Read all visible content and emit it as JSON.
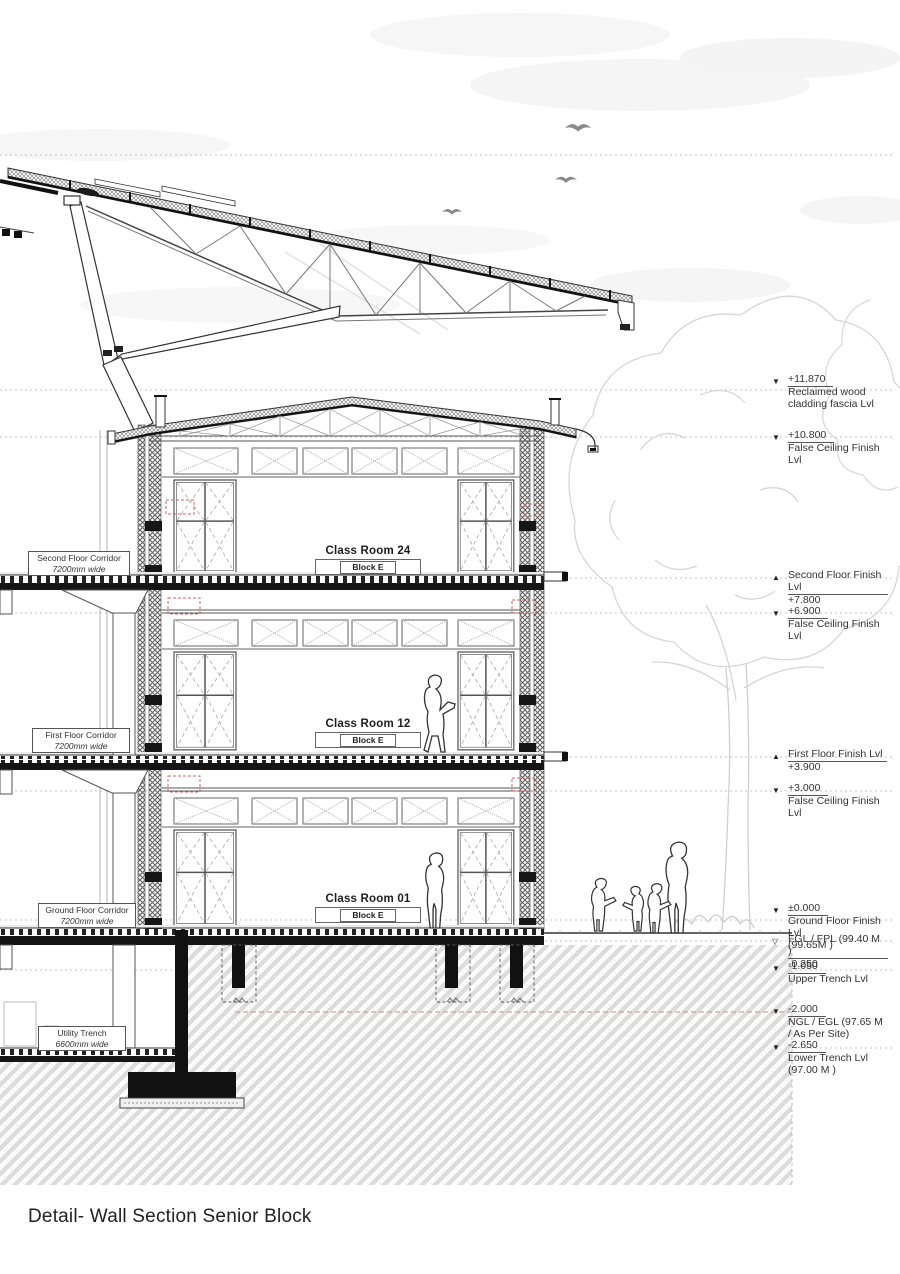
{
  "page": {
    "title": "Detail- Wall Section Senior Block"
  },
  "rooms": [
    {
      "name": "Class Room 24",
      "block": "Block E"
    },
    {
      "name": "Class Room 12",
      "block": "Block E"
    },
    {
      "name": "Class Room 01",
      "block": "Block E"
    }
  ],
  "corridors": [
    {
      "name": "Second Floor Corridor",
      "width": "7200mm wide"
    },
    {
      "name": "First Floor Corridor",
      "width": "7200mm wide"
    },
    {
      "name": "Ground Floor Corridor",
      "width": "7200mm wide"
    },
    {
      "name": "Utility Trench",
      "width": "6600mm wide"
    }
  ],
  "levels": [
    {
      "value": "+11.870",
      "label": "Reclaimed wood cladding fascia Lvl",
      "glyph": "▼"
    },
    {
      "value": "+10.800",
      "label": "False Ceiling Finish Lvl",
      "glyph": "▼"
    },
    {
      "value": "+7.800",
      "label": "Second Floor Finish Lvl",
      "glyph": "▲"
    },
    {
      "value": "+6.900",
      "label": "False Ceiling Finish Lvl",
      "glyph": "▼"
    },
    {
      "value": "+3.900",
      "label": "First Floor Finish Lvl",
      "glyph": "▲"
    },
    {
      "value": "+3.000",
      "label": "False Ceiling Finish Lvl",
      "glyph": "▼"
    },
    {
      "value": "±0.000",
      "label": "Ground Floor Finish Lvl",
      "extra": "(99.65M )",
      "glyph": "▼"
    },
    {
      "value": "-0.250",
      "label": "FGL / FPL (99.40 M )",
      "glyph": "▽"
    },
    {
      "value": "-1.050",
      "label": "Upper Trench Lvl",
      "glyph": "▼"
    },
    {
      "value": "-2.000",
      "label": "NGL / EGL (97.65 M / As Per Site)",
      "glyph": "▼"
    },
    {
      "value": "-2.650",
      "label": "Lower Trench Lvl",
      "extra": "(97.00 M )",
      "glyph": "▼"
    }
  ],
  "colors": {
    "linework": "#333333",
    "hatch_gray": "#dcdcdc",
    "red_dashed": "#cc6666",
    "black_fill": "#111111"
  }
}
